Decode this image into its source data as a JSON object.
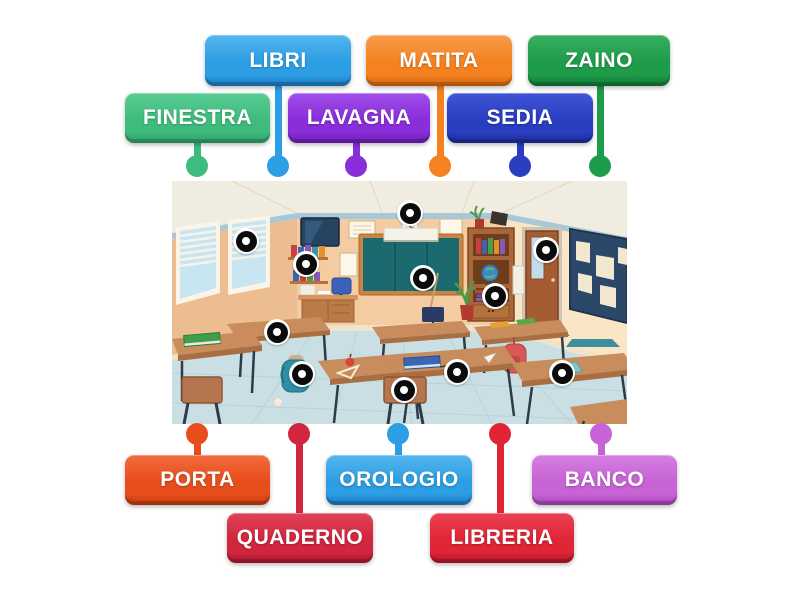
{
  "labels": [
    {
      "id": "finestra",
      "text": "FINESTRA",
      "color": "#3FBC7D",
      "light": "#5ACD94",
      "dark": "#2E9E65",
      "x": 125,
      "y": 93,
      "w": 145,
      "h": 50,
      "dot_x": 197,
      "dot_y": 166
    },
    {
      "id": "libri",
      "text": "LIBRI",
      "color": "#2D9EE3",
      "light": "#54B6F0",
      "dark": "#1878C0",
      "x": 205,
      "y": 35,
      "w": 146,
      "h": 51,
      "dot_x": 278,
      "dot_y": 166
    },
    {
      "id": "lavagna",
      "text": "LAVAGNA",
      "color": "#8A2EDC",
      "light": "#A04FE8",
      "dark": "#6B1DB2",
      "x": 288,
      "y": 93,
      "w": 142,
      "h": 50,
      "dot_x": 356,
      "dot_y": 166
    },
    {
      "id": "matita",
      "text": "MATITA",
      "color": "#F58220",
      "light": "#F89C4B",
      "dark": "#D2660C",
      "x": 366,
      "y": 35,
      "w": 146,
      "h": 51,
      "dot_x": 440,
      "dot_y": 166
    },
    {
      "id": "sedia",
      "text": "SEDIA",
      "color": "#2A3EC2",
      "light": "#4054D6",
      "dark": "#1B2B96",
      "x": 447,
      "y": 93,
      "w": 146,
      "h": 50,
      "dot_x": 520,
      "dot_y": 166
    },
    {
      "id": "zaino",
      "text": "ZAINO",
      "color": "#1E9C49",
      "light": "#38AF61",
      "dark": "#137738",
      "x": 528,
      "y": 35,
      "w": 142,
      "h": 51,
      "dot_x": 600,
      "dot_y": 166
    },
    {
      "id": "porta",
      "text": "PORTA",
      "color": "#E84E1C",
      "light": "#F26B3C",
      "dark": "#C1390E",
      "x": 125,
      "y": 455,
      "w": 145,
      "h": 50,
      "dot_x": 197,
      "dot_y": 434
    },
    {
      "id": "quaderno",
      "text": "QUADERNO",
      "color": "#D2263F",
      "light": "#DF4458",
      "dark": "#A9152C",
      "x": 227,
      "y": 513,
      "w": 146,
      "h": 50,
      "dot_x": 299,
      "dot_y": 434
    },
    {
      "id": "orologio",
      "text": "OROLOGIO",
      "color": "#2D9EE3",
      "light": "#54B6F0",
      "dark": "#1878C0",
      "x": 326,
      "y": 455,
      "w": 146,
      "h": 50,
      "dot_x": 398,
      "dot_y": 434
    },
    {
      "id": "libreria",
      "text": "LIBRERIA",
      "color": "#E02536",
      "light": "#EC4253",
      "dark": "#B41529",
      "x": 430,
      "y": 513,
      "w": 144,
      "h": 50,
      "dot_x": 500,
      "dot_y": 434
    },
    {
      "id": "banco",
      "text": "BANCO",
      "color": "#C763D5",
      "light": "#D67FE2",
      "dark": "#A443B4",
      "x": 532,
      "y": 455,
      "w": 145,
      "h": 50,
      "dot_x": 601,
      "dot_y": 434
    }
  ],
  "scene": {
    "x": 172,
    "y": 181,
    "w": 455,
    "h": 243,
    "markers": [
      {
        "x": 246,
        "y": 241
      },
      {
        "x": 306,
        "y": 264
      },
      {
        "x": 410,
        "y": 213
      },
      {
        "x": 423,
        "y": 278
      },
      {
        "x": 546,
        "y": 250
      },
      {
        "x": 495,
        "y": 296
      },
      {
        "x": 277,
        "y": 332
      },
      {
        "x": 302,
        "y": 374
      },
      {
        "x": 457,
        "y": 372
      },
      {
        "x": 404,
        "y": 390
      },
      {
        "x": 562,
        "y": 373
      }
    ],
    "palette": {
      "ceiling": "#F0ECE0",
      "trim": "#A7C8D8",
      "wall_back": "#F5CBA1",
      "wall_left": "#EDBD92",
      "wall_right": "#FAE5C4",
      "floor": "#C9DFE3",
      "chalkboard": "#1A6A70",
      "wood": "#C98A54",
      "bulletin": "#2C4868",
      "window_pane": "#C7E6F2"
    }
  }
}
